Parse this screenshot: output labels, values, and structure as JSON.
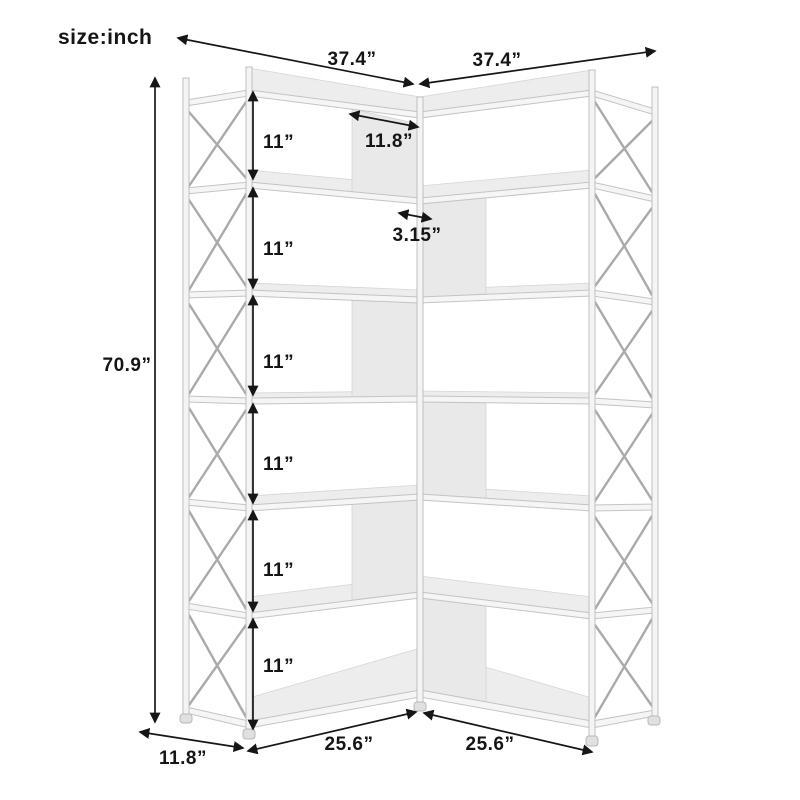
{
  "page": {
    "size_note": "size:inch"
  },
  "dimensions": {
    "top_left_width": "37.4”",
    "top_right_width": "37.4”",
    "top_shelf_depth": "11.8”",
    "corner_offset": "3.15”",
    "total_height": "70.9”",
    "tier_heights": [
      "11”",
      "11”",
      "11”",
      "11”",
      "11”",
      "11”"
    ],
    "bottom_side_depth": "11.8”",
    "bottom_left_width": "25.6”",
    "bottom_right_width": "25.6”"
  },
  "colors": {
    "dimension_ink": "#161616",
    "shelf_fill": "#f5f5f5",
    "shelf_edge": "#c4c4c4",
    "divider_fill": "#e9e9e9",
    "background": "#ffffff"
  }
}
